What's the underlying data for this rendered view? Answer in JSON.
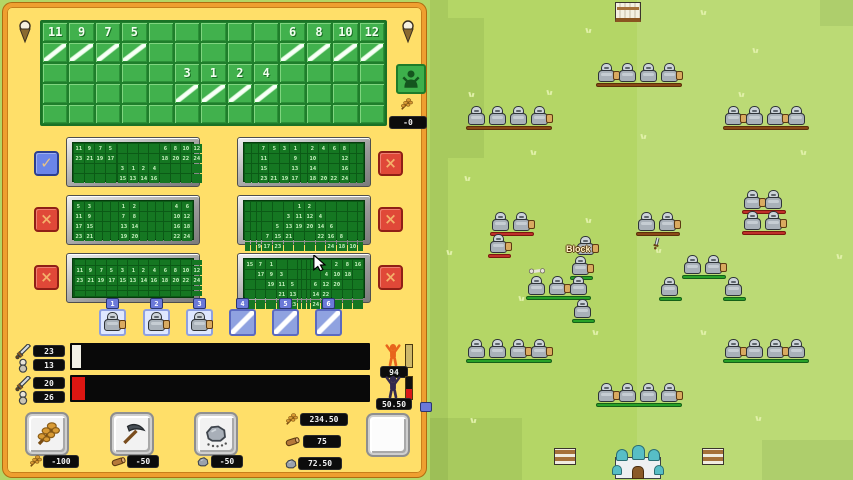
{
  "colors": {
    "panel_bg": "#ffdf69",
    "panel_border": "#ef9f30",
    "grid_green": "#41b14d",
    "field_base": "#b4d666",
    "field_right": "#c2e17c",
    "bench_green": "#28a228",
    "bench_brown": "#8a4a16",
    "bench_red": "#c0302a"
  },
  "panel": {
    "pins": {
      "icon": "pin-icon"
    },
    "main_grid": {
      "cols": 13,
      "rows": 5,
      "cells": [
        [
          "11",
          "9",
          "7",
          "5",
          "",
          "",
          "",
          "",
          "",
          "6",
          "8",
          "10",
          "12"
        ],
        [
          "sl",
          "sl",
          "sl",
          "sl",
          "",
          "",
          "",
          "",
          "",
          "sl",
          "sl",
          "sl",
          "sl"
        ],
        [
          "",
          "",
          "",
          "",
          "",
          "3",
          "1",
          "2",
          "4",
          "",
          "",
          "",
          ""
        ],
        [
          "",
          "",
          "",
          "",
          "",
          "sl",
          "sl",
          "sl",
          "sl",
          "",
          "",
          "",
          ""
        ],
        [
          "",
          "",
          "",
          "",
          "",
          "",
          "",
          "",
          "",
          "",
          "",
          "",
          ""
        ]
      ]
    },
    "villager_button": {
      "icon": "villager-icon"
    },
    "wheat_rate": {
      "icon": "wheat-icon",
      "value": "-0"
    },
    "presets": [
      {
        "grid": [
          [
            "11",
            "9",
            "7",
            "5",
            "",
            "",
            "",
            "",
            "",
            "6",
            "8",
            "10",
            "12"
          ],
          [
            "23",
            "21",
            "19",
            "17",
            "",
            "",
            "",
            "",
            "",
            "18",
            "20",
            "22",
            "24"
          ],
          [
            "",
            "",
            "",
            "",
            "",
            "3",
            "1",
            "2",
            "4",
            "",
            "",
            "",
            ""
          ],
          [
            "",
            "",
            "",
            "",
            "",
            "15",
            "13",
            "14",
            "16",
            "",
            "",
            "",
            ""
          ],
          [
            "",
            "",
            "",
            "",
            "",
            "",
            "",
            "",
            "",
            "",
            "",
            "",
            ""
          ]
        ]
      },
      {
        "grid": [
          [
            "",
            "",
            "7",
            "5",
            "3",
            "1",
            "",
            "2",
            "4",
            "6",
            "8",
            "",
            ""
          ],
          [
            "",
            "",
            "11",
            "",
            "",
            "9",
            "",
            "10",
            "",
            "",
            "12",
            "",
            ""
          ],
          [
            "",
            "",
            "15",
            "",
            "",
            "13",
            "",
            "14",
            "",
            "",
            "16",
            "",
            ""
          ],
          [
            "",
            "",
            "23",
            "21",
            "19",
            "17",
            "",
            "18",
            "20",
            "22",
            "24",
            "",
            ""
          ],
          [
            "",
            "",
            "",
            "",
            "",
            "",
            "",
            "",
            "",
            "",
            "",
            "",
            ""
          ]
        ]
      },
      {
        "grid": [
          [
            "5",
            "3",
            "",
            "",
            "",
            "1",
            "2",
            "",
            "",
            "",
            "",
            "4",
            "6"
          ],
          [
            "11",
            "9",
            "",
            "",
            "",
            "7",
            "8",
            "",
            "",
            "",
            "",
            "10",
            "12"
          ],
          [
            "17",
            "15",
            "",
            "",
            "",
            "13",
            "14",
            "",
            "",
            "",
            "",
            "16",
            "18"
          ],
          [
            "23",
            "21",
            "",
            "",
            "",
            "19",
            "20",
            "",
            "",
            "",
            "",
            "22",
            "24"
          ],
          [
            "",
            "",
            "",
            "",
            "",
            "",
            "",
            "",
            "",
            "",
            "",
            "",
            ""
          ]
        ]
      },
      {
        "grid": [
          [
            "",
            "",
            "",
            "",
            "",
            "",
            "1",
            "2",
            "",
            "",
            "",
            "",
            ""
          ],
          [
            "",
            "",
            "",
            "",
            "",
            "3",
            "11",
            "12",
            "4",
            "",
            "",
            "",
            ""
          ],
          [
            "",
            "",
            "",
            "",
            "5",
            "13",
            "19",
            "20",
            "14",
            "6",
            "",
            "",
            ""
          ],
          [
            "",
            "",
            "",
            "7",
            "15",
            "21",
            "",
            "",
            "22",
            "16",
            "8",
            "",
            ""
          ],
          [
            "",
            "",
            "9",
            "17",
            "23",
            "",
            "",
            "",
            "",
            "24",
            "18",
            "10",
            ""
          ]
        ]
      },
      {
        "grid": [
          [
            "",
            "",
            "",
            "",
            "",
            "",
            "",
            "",
            "",
            "",
            "",
            "",
            ""
          ],
          [
            "",
            "11",
            "9",
            "7",
            "5",
            "3",
            "1",
            "2",
            "4",
            "6",
            "8",
            "10",
            "12"
          ],
          [
            "",
            "23",
            "21",
            "19",
            "17",
            "15",
            "13",
            "14",
            "16",
            "18",
            "20",
            "22",
            "24"
          ],
          [
            "",
            "",
            "",
            "",
            "",
            "",
            "",
            "",
            "",
            "",
            "",
            "",
            ""
          ],
          [
            "",
            "",
            "",
            "",
            "",
            "",
            "",
            "",
            "",
            "",
            "",
            "",
            ""
          ]
        ]
      },
      {
        "grid": [
          [
            "15",
            "7",
            "1",
            "",
            "",
            "",
            "",
            "",
            "",
            "",
            "2",
            "8",
            "16"
          ],
          [
            "",
            "17",
            "9",
            "3",
            "",
            "",
            "",
            "",
            "",
            "4",
            "10",
            "18",
            ""
          ],
          [
            "",
            "",
            "19",
            "11",
            "5",
            "",
            "",
            "",
            "6",
            "12",
            "20",
            "",
            ""
          ],
          [
            "",
            "",
            "",
            "21",
            "13",
            "",
            "",
            "",
            "14",
            "22",
            "",
            "",
            ""
          ],
          [
            "",
            "",
            "",
            "",
            "23",
            "",
            "",
            "",
            "24",
            "",
            "",
            "",
            ""
          ]
        ]
      }
    ],
    "left_buttons": [
      {
        "type": "check",
        "glyph": "✓"
      },
      {
        "type": "x",
        "glyph": "×"
      },
      {
        "type": "x",
        "glyph": "×"
      }
    ],
    "right_buttons": [
      {
        "type": "x",
        "glyph": "×"
      },
      {
        "type": "x",
        "glyph": "×"
      },
      {
        "type": "x",
        "glyph": "×"
      }
    ],
    "unit_slots": [
      {
        "tab": "1",
        "filled": true
      },
      {
        "tab": "2",
        "filled": true
      },
      {
        "tab": "3",
        "filled": true
      },
      {
        "tab": "4",
        "filled": false
      },
      {
        "tab": "5",
        "filled": false
      },
      {
        "tab": "6",
        "filled": false
      }
    ],
    "stat_rows": [
      {
        "attack": "23",
        "defense": "13",
        "fill_color": "#f2f0e6",
        "fill_px": 9,
        "figure_badge": "94",
        "figure_color": "#e8641c",
        "side_top": "#cdb86a",
        "side_bottom": "#cdb86a"
      },
      {
        "attack": "20",
        "defense": "26",
        "fill_color": "#dd1612",
        "fill_px": 13,
        "figure_badge": "50.50",
        "figure_color": "#342a4e",
        "side_top": "#101010",
        "side_bottom": "#d81818"
      }
    ],
    "shop_buttons": [
      {
        "icon": "wheat-icon",
        "cost_icon": "wheat-icon",
        "cost": "-100"
      },
      {
        "icon": "pickaxe-icon",
        "cost_icon": "wood-icon",
        "cost": "-50"
      },
      {
        "icon": "boulder-icon",
        "cost_icon": "stone-icon",
        "cost": "-50"
      }
    ],
    "resources": [
      {
        "icon": "wheat-icon",
        "value": "234.50"
      },
      {
        "icon": "wood-icon",
        "value": "75"
      },
      {
        "icon": "stone-icon",
        "value": "72.50"
      }
    ]
  },
  "battlefield": {
    "block_label": {
      "text": "Block",
      "x": 566,
      "y": 244
    },
    "groups": [
      {
        "x": 598,
        "y": 63,
        "n": 4,
        "bench": "brown",
        "sh": [
          0,
          3
        ]
      },
      {
        "x": 468,
        "y": 106,
        "n": 4,
        "bench": "brown",
        "sh": [
          3
        ]
      },
      {
        "x": 725,
        "y": 106,
        "n": 4,
        "bench": "brown",
        "sh": [
          0,
          2
        ]
      },
      {
        "x": 492,
        "y": 212,
        "n": 2,
        "bench": "red",
        "sh": [
          1
        ]
      },
      {
        "x": 490,
        "y": 234,
        "n": 1,
        "bench": "red",
        "sh": [
          0
        ]
      },
      {
        "x": 577,
        "y": 236,
        "n": 1,
        "bench": "none",
        "sh": [
          0
        ]
      },
      {
        "x": 572,
        "y": 256,
        "n": 1,
        "bench": "green",
        "sh": [
          0
        ]
      },
      {
        "x": 528,
        "y": 276,
        "n": 3,
        "bench": "green",
        "sh": [
          1
        ]
      },
      {
        "x": 574,
        "y": 299,
        "n": 1,
        "bench": "green",
        "sh": []
      },
      {
        "x": 638,
        "y": 212,
        "n": 2,
        "bench": "brown",
        "sh": [
          1
        ]
      },
      {
        "x": 744,
        "y": 190,
        "n": 2,
        "bench": "red",
        "sh": [
          0
        ]
      },
      {
        "x": 744,
        "y": 211,
        "n": 2,
        "bench": "red",
        "sh": [
          1
        ]
      },
      {
        "x": 684,
        "y": 255,
        "n": 2,
        "bench": "green",
        "sh": [
          1
        ]
      },
      {
        "x": 661,
        "y": 277,
        "n": 1,
        "bench": "green",
        "sh": []
      },
      {
        "x": 725,
        "y": 277,
        "n": 1,
        "bench": "green",
        "sh": []
      },
      {
        "x": 468,
        "y": 339,
        "n": 4,
        "bench": "green",
        "sh": [
          2,
          3
        ]
      },
      {
        "x": 725,
        "y": 339,
        "n": 4,
        "bench": "green",
        "sh": [
          0,
          2
        ]
      },
      {
        "x": 598,
        "y": 383,
        "n": 4,
        "bench": "green",
        "sh": [
          0,
          3
        ]
      }
    ],
    "props": {
      "tent": {
        "x": 615,
        "y": 2
      },
      "barricades": [
        {
          "x": 554,
          "y": 448
        },
        {
          "x": 702,
          "y": 448
        }
      ],
      "castle": {
        "x": 613,
        "y": 445
      },
      "drops": [
        {
          "type": "sword",
          "x": 650,
          "y": 236
        },
        {
          "type": "bone",
          "x": 529,
          "y": 264
        }
      ]
    },
    "tufts": [
      [
        585,
        28
      ],
      [
        700,
        10
      ],
      [
        752,
        48
      ],
      [
        468,
        92
      ],
      [
        546,
        90
      ],
      [
        738,
        92
      ],
      [
        640,
        134
      ],
      [
        464,
        176
      ],
      [
        585,
        218
      ],
      [
        668,
        222
      ],
      [
        518,
        296
      ],
      [
        655,
        248
      ],
      [
        470,
        418
      ],
      [
        592,
        330
      ],
      [
        755,
        416
      ],
      [
        700,
        330
      ],
      [
        836,
        254
      ],
      [
        446,
        250
      ],
      [
        530,
        150
      ],
      [
        800,
        150
      ]
    ],
    "cursor": {
      "x": 313,
      "y": 255
    }
  }
}
